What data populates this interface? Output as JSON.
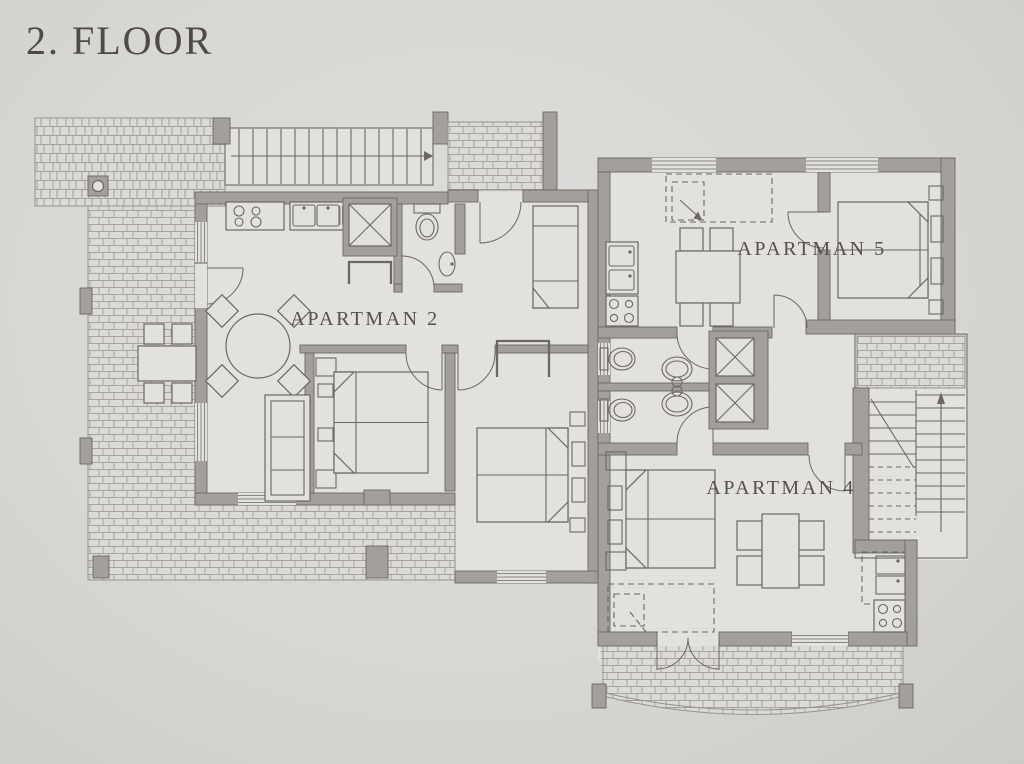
{
  "title": "2. FLOOR",
  "apartments": [
    {
      "id": "apartman-2",
      "label": "APARTMAN 2"
    },
    {
      "id": "apartman-4",
      "label": "APARTMAN 4"
    },
    {
      "id": "apartman-5",
      "label": "APARTMAN 5"
    }
  ],
  "icons": {
    "straight-staircase-icon": "straight stair run with direction arrow",
    "u-staircase-icon": "U-return staircase with up arrow and break line",
    "elevator-shaft-icon": "square shaft with X cross",
    "stove-icon": "four burner circles",
    "kitchen-sink-icon": "double basin sink with faucets",
    "toilet-icon": "toilet bowl with tank",
    "washbasin-icon": "oval pedestal basin",
    "round-table-icon": "round dining table with four diagonal chairs",
    "dining-table-icon": "rectangular table with four chairs",
    "sofa-icon": "three seat sofa",
    "twin-beds-icon": "two single beds with folded linen corners",
    "single-bed-icon": "single bed with folded corner",
    "sofa-bed-icon": "dashed fold-out guest bed",
    "door-icon": "door swing arc",
    "window-icon": "triple glazing lines in wall",
    "terrace-icon": "stone paving hatch",
    "balcony-icon": "curved stone balcony parapet"
  },
  "colors": {
    "paper": "#d8d7d3",
    "room": "#e2e1dd",
    "wall": "#a3a09b",
    "line": "#6b6762",
    "hatch": "#96938f",
    "text": "#4e4a45"
  }
}
